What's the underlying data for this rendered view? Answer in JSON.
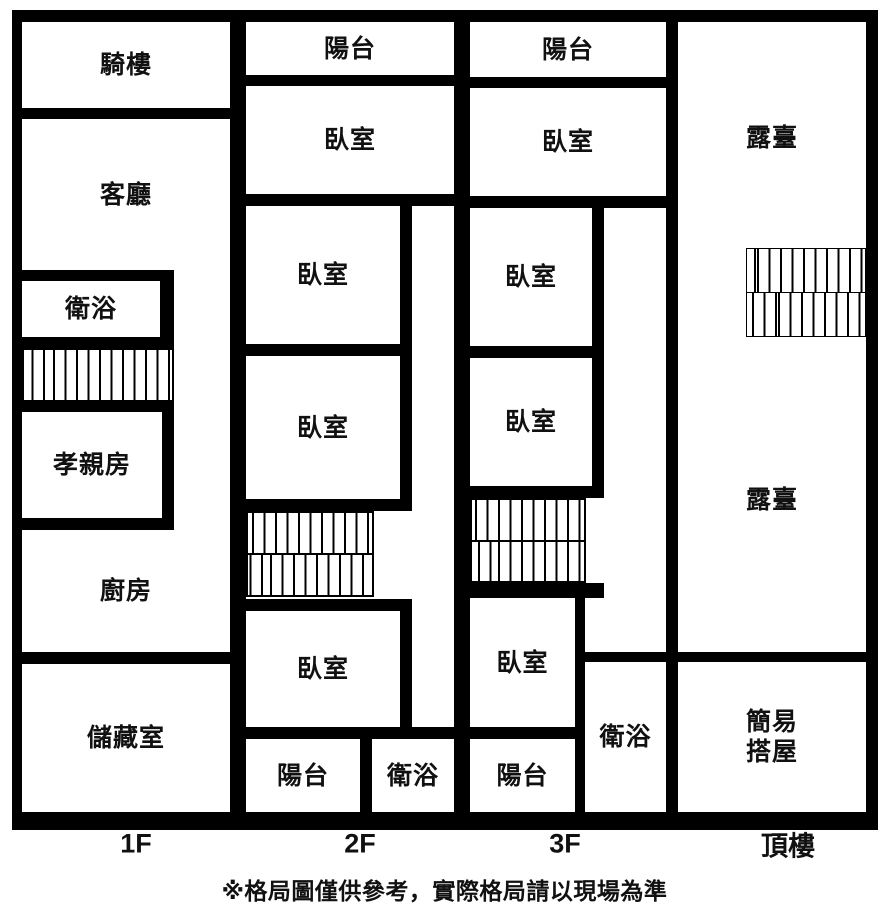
{
  "title": "floor-plan",
  "colors": {
    "wall": "#000000",
    "floor": "#ffffff",
    "text": "#111111"
  },
  "note": "※格局圖僅供參考，實際格局請以現場為準",
  "floors": [
    {
      "label": "1F",
      "rooms": {
        "qilou": "騎樓",
        "keting": "客廳",
        "weiyu": "衛浴",
        "xiaoqin": "孝親房",
        "chufang": "廚房",
        "chucang": "儲藏室"
      }
    },
    {
      "label": "2F",
      "rooms": {
        "yangtai_top": "陽台",
        "woshi1": "臥室",
        "woshi2": "臥室",
        "woshi3": "臥室",
        "woshi4": "臥室",
        "yangtai_btm": "陽台",
        "weiyu": "衛浴"
      }
    },
    {
      "label": "3F",
      "rooms": {
        "yangtai_top": "陽台",
        "woshi1": "臥室",
        "woshi2": "臥室",
        "woshi3": "臥室",
        "woshi4": "臥室",
        "yangtai_btm": "陽台",
        "weiyu": "衛浴"
      }
    },
    {
      "label": "頂樓",
      "rooms": {
        "lutai_upper": "露臺",
        "lutai_lower": "露臺",
        "shed_line1": "簡易",
        "shed_line2": "搭屋"
      }
    }
  ]
}
